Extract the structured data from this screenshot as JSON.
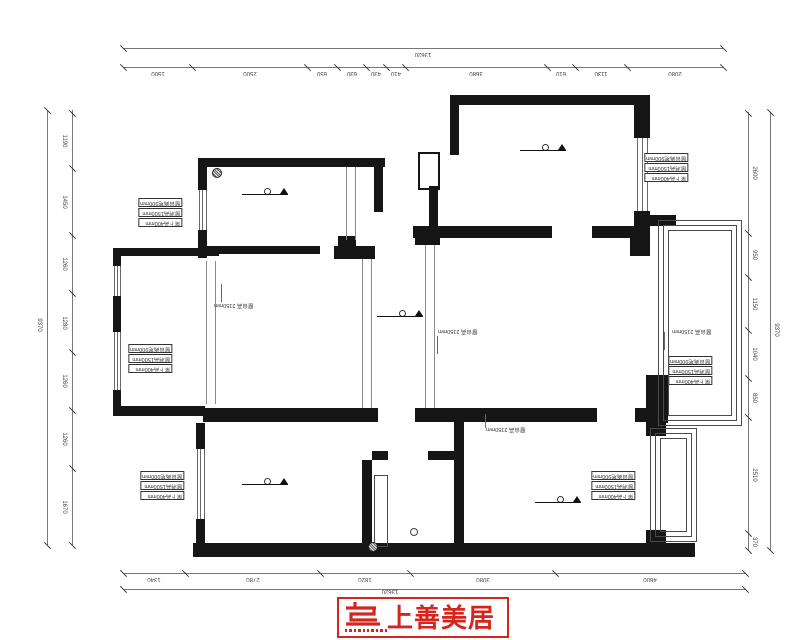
{
  "title": "residential floor plan (drawing rotated 180°)",
  "accent_color": "#d3261f",
  "level_value": "+2.700",
  "rooms": [
    {
      "id": "kitchen",
      "label": "厨房",
      "x": 258,
      "y": 207
    },
    {
      "id": "study",
      "label": "书房",
      "x": 533,
      "y": 185
    },
    {
      "id": "bedroom",
      "label": "卧室",
      "x": 160,
      "y": 327
    },
    {
      "id": "dining",
      "label": "餐厅",
      "x": 247,
      "y": 339
    },
    {
      "id": "living",
      "label": "客厅",
      "x": 526,
      "y": 305
    },
    {
      "id": "balcony",
      "label": "阳台",
      "x": 701,
      "y": 312
    },
    {
      "id": "second-bedroom",
      "label": "次卧",
      "x": 317,
      "y": 484
    },
    {
      "id": "bathroom",
      "label": "卫生间",
      "x": 427,
      "y": 506
    },
    {
      "id": "master-bedroom",
      "label": "主卧",
      "x": 562,
      "y": 486
    }
  ],
  "level_markers": {
    "value": "+2.700",
    "positions": [
      {
        "x": 240,
        "y": 184
      },
      {
        "x": 518,
        "y": 140
      },
      {
        "x": 375,
        "y": 306
      },
      {
        "x": 240,
        "y": 474
      },
      {
        "x": 533,
        "y": 492
      }
    ]
  },
  "dimensions": {
    "top": {
      "overall": {
        "value": "13620",
        "line_y": 48,
        "x1": 123,
        "x2": 723,
        "label_x": 423
      },
      "segments": {
        "line_y": 67,
        "ticks": [
          123,
          192,
          307,
          337,
          366,
          386,
          405,
          547,
          575,
          627,
          723
        ],
        "values": [
          "1500",
          "2500",
          "650",
          "630",
          "430",
          "410",
          "3680",
          "610",
          "1130",
          "2080"
        ]
      }
    },
    "bottom": {
      "segments": {
        "line_y": 573,
        "ticks": [
          123,
          185,
          320,
          410,
          555,
          745
        ],
        "values": [
          "1340",
          "2780",
          "1820",
          "3080",
          "4600"
        ]
      },
      "overall": {
        "value": "13620",
        "line_y": 589,
        "x1": 123,
        "x2": 745,
        "label_x": 390
      }
    },
    "left": {
      "overall": {
        "value": "9370",
        "line_x": 47,
        "y1": 110,
        "y2": 545,
        "label_y": 325
      },
      "segments": {
        "line_x": 72,
        "ticks": [
          113,
          168,
          235,
          293,
          352,
          410,
          468,
          545
        ],
        "values": [
          "1190",
          "1450",
          "1260",
          "1280",
          "1260",
          "1260",
          "1670"
        ]
      }
    },
    "right": {
      "segments": {
        "line_x": 748,
        "ticks": [
          113,
          233,
          277,
          330,
          378,
          417,
          533,
          550
        ],
        "values": [
          "2600",
          "950",
          "1150",
          "1040",
          "850",
          "2510",
          "370"
        ]
      },
      "overall": {
        "value": "9370",
        "line_x": 770,
        "y1": 112,
        "y2": 550,
        "label_y": 330
      }
    }
  },
  "annotations": {
    "boxed_rows": [
      "窗台离地900mm",
      "窗洞高1500mm",
      "梁下高400mm"
    ],
    "boxed_positions": [
      {
        "x": 138,
        "y": 198
      },
      {
        "x": 128,
        "y": 344
      },
      {
        "x": 140,
        "y": 471
      },
      {
        "x": 644,
        "y": 153
      },
      {
        "x": 668,
        "y": 356
      },
      {
        "x": 591,
        "y": 471
      }
    ],
    "leader_text": "窗台高 2150mm",
    "leader_positions": [
      {
        "x": 214,
        "y": 302,
        "lx": 221,
        "ly": 284,
        "lh": 18
      },
      {
        "x": 438,
        "y": 328,
        "lx": 437,
        "ly": 336,
        "lh": 18
      },
      {
        "x": 672,
        "y": 328,
        "lx": 664,
        "ly": 332,
        "lh": 18
      },
      {
        "x": 486,
        "y": 426,
        "lx": 485,
        "ly": 414,
        "lh": 14
      }
    ]
  },
  "logo": {
    "brand": "上善美居",
    "mark": "stylized-S-monogram",
    "color": "#d3261f"
  }
}
